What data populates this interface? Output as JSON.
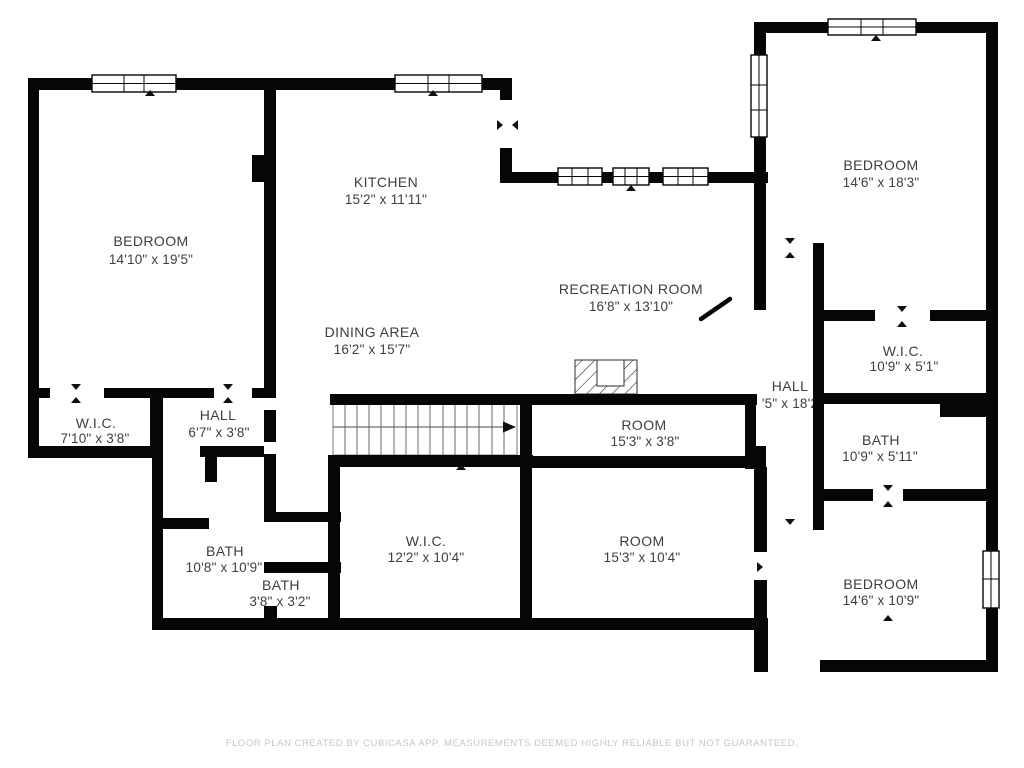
{
  "document": {
    "type": "floor-plan",
    "creator_disclaimer": "FLOOR PLAN CREATED BY CUBICASA APP. MEASUREMENTS DEEMED HIGHLY RELIABLE BUT NOT GUARANTEED."
  },
  "colors": {
    "background": "#ffffff",
    "wall": "#060606",
    "label_text": "#3e3e3e",
    "footer_text": "#c6c6c6"
  },
  "features": {
    "stairs_icon": "staircase-with-direction-arrow",
    "fireplace_icon": "hatched-fireplace",
    "window_icon": "double-pane-window",
    "door_icon": "door-opening-ticks"
  },
  "rooms": [
    {
      "id": "bedroom-upper-left",
      "name": "BEDROOM",
      "dims": "14'10\" x 19'5\""
    },
    {
      "id": "kitchen",
      "name": "KITCHEN",
      "dims": "15'2\" x 11'11\""
    },
    {
      "id": "dining-area",
      "name": "DINING AREA",
      "dims": "16'2\" x 15'7\""
    },
    {
      "id": "recreation-room",
      "name": "RECREATION ROOM",
      "dims": "16'8\" x 13'10\""
    },
    {
      "id": "bedroom-upper-right",
      "name": "BEDROOM",
      "dims": "14'6\" x 18'3\""
    },
    {
      "id": "wic-right",
      "name": "W.I.C.",
      "dims": "10'9\" x 5'1\""
    },
    {
      "id": "hall-center",
      "name": "HALL",
      "dims": "'5\" x 18'2"
    },
    {
      "id": "bath-right",
      "name": "BATH",
      "dims": "10'9\" x 5'11\""
    },
    {
      "id": "room-upper",
      "name": "ROOM",
      "dims": "15'3\" x 3'8\""
    },
    {
      "id": "room-lower",
      "name": "ROOM",
      "dims": "15'3\" x 10'4\""
    },
    {
      "id": "bedroom-lower-right",
      "name": "BEDROOM",
      "dims": "14'6\" x 10'9\""
    },
    {
      "id": "wic-left",
      "name": "W.I.C.",
      "dims": "7'10\" x 3'8\""
    },
    {
      "id": "hall-left",
      "name": "HALL",
      "dims": "6'7\" x 3'8\""
    },
    {
      "id": "bath-left",
      "name": "BATH",
      "dims": "10'8\" x 10'9\""
    },
    {
      "id": "bath-small",
      "name": "BATH",
      "dims": "3'8\" x 3'2\""
    },
    {
      "id": "wic-center",
      "name": "W.I.C.",
      "dims": "12'2\" x 10'4\""
    }
  ]
}
